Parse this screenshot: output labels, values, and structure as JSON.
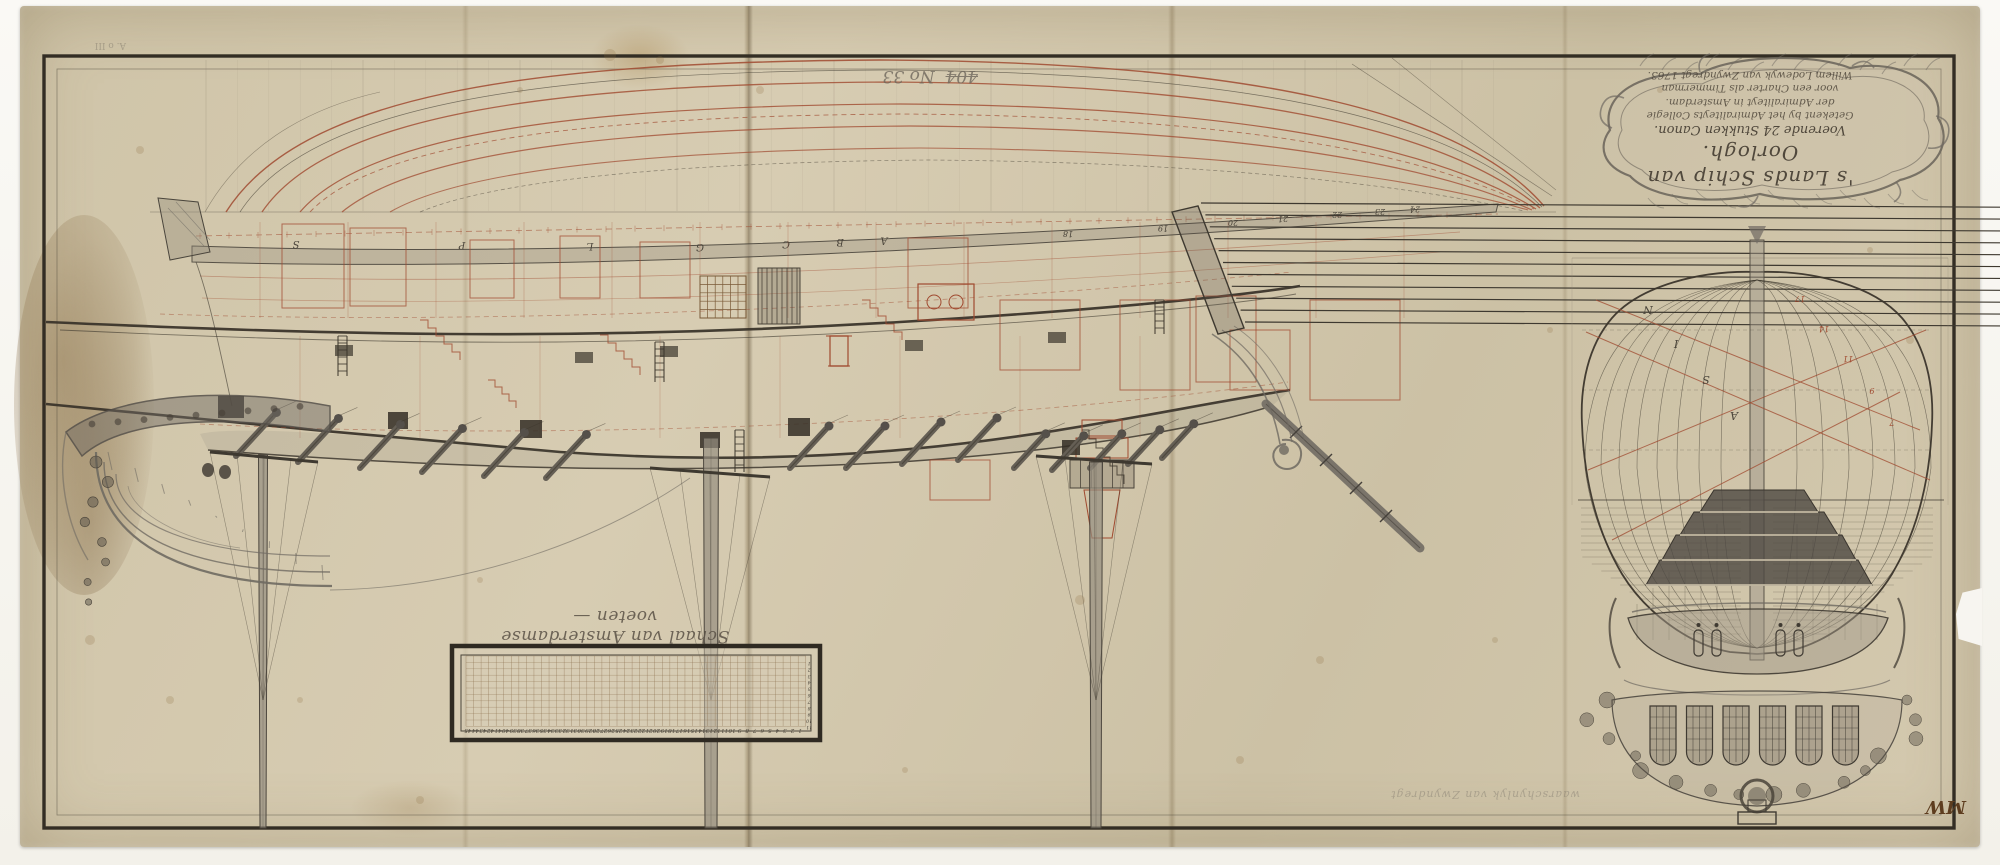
{
  "cartouche": {
    "lines": [
      "'s Lands Schip van Oorlogh.",
      "Voerende 24 Stukken Canon.",
      "Getekent by het Admiraliteyts Collegie",
      "der Admiraliteyt in Amsterdam.",
      "voor een Charter als Timmerman",
      "Willem Lodewyk van Zwyndregt 1763."
    ]
  },
  "annotations": {
    "struck_number": "404",
    "inventory_number": "No 33",
    "pencil_note": "waarschynlyk van Zwyndregt",
    "collector_mark": "MW",
    "corner_mark": "A. o III"
  },
  "scale_bar": {
    "caption": "Schaal van Amsterdamse voeten —",
    "feet_numbers": [
      1,
      2,
      3,
      4,
      5,
      6,
      7,
      8,
      9,
      10,
      11,
      12,
      13,
      14,
      15,
      16,
      17,
      18,
      19,
      20,
      21,
      22,
      23,
      24,
      25,
      26,
      27,
      28,
      29,
      30,
      31,
      32,
      33,
      34,
      35,
      36,
      37,
      38,
      39,
      40,
      41,
      42,
      43,
      44,
      45
    ],
    "inch_numbers": [
      1,
      2,
      3,
      4,
      5,
      6,
      7,
      8,
      9,
      10,
      11
    ]
  },
  "profile": {
    "station_letters": [
      "S",
      "P",
      "L",
      "G",
      "C",
      "B",
      "A"
    ],
    "station_numbers": [
      "18",
      "19",
      "20",
      "21",
      "22",
      "23",
      "24"
    ]
  },
  "body_plan": {
    "left_letters": [
      "N",
      "I",
      "S",
      "A"
    ],
    "right_numbers": [
      "17",
      "14",
      "11",
      "9",
      "7"
    ]
  },
  "colors": {
    "paper": "#d2c6ab",
    "ink": "#3b352b",
    "red_ink": "#a04a30",
    "wash_gray": "#6f6a62",
    "collector_ink": "#5e3d1f"
  }
}
